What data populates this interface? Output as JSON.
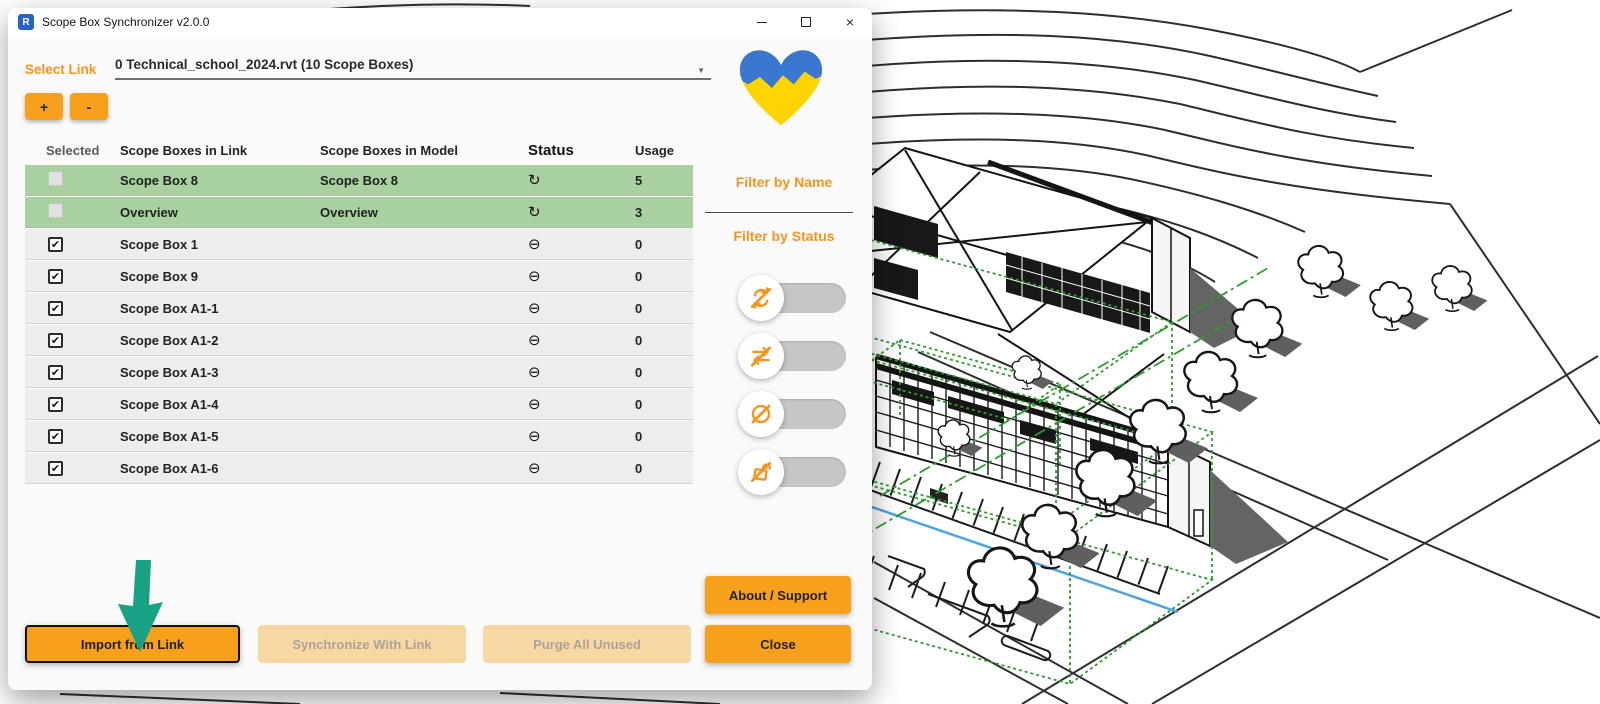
{
  "window": {
    "title": "Scope Box Synchronizer v2.0.0",
    "app_icon_letter": "R",
    "controls": {
      "minimize": "minimize",
      "maximize": "maximize",
      "close_glyph": "×"
    }
  },
  "link_selector": {
    "label": "Select Link",
    "value": "0 Technical_school_2024.rvt (10 Scope Boxes)",
    "dropdown_arrow": "▼",
    "add_label": "+",
    "remove_label": "-"
  },
  "table": {
    "columns": [
      "Selected",
      "Scope Boxes in Link",
      "Scope Boxes in Model",
      "Status",
      "Usage"
    ],
    "rows": [
      {
        "link": "Scope Box 8",
        "model": "Scope Box 8",
        "status": "synced",
        "status_glyph": "↻",
        "usage": "5",
        "checked": false,
        "checkbox_enabled": false,
        "highlighted": true
      },
      {
        "link": "Overview",
        "model": "Overview",
        "status": "synced",
        "status_glyph": "↻",
        "usage": "3",
        "checked": false,
        "checkbox_enabled": false,
        "highlighted": true
      },
      {
        "link": "Scope Box 1",
        "model": "",
        "status": "not-in-model",
        "status_glyph": "⊖",
        "usage": "0",
        "checked": true,
        "checkbox_enabled": true,
        "highlighted": false
      },
      {
        "link": "Scope Box 9",
        "model": "",
        "status": "not-in-model",
        "status_glyph": "⊖",
        "usage": "0",
        "checked": true,
        "checkbox_enabled": true,
        "highlighted": false
      },
      {
        "link": "Scope Box A1-1",
        "model": "",
        "status": "not-in-model",
        "status_glyph": "⊖",
        "usage": "0",
        "checked": true,
        "checkbox_enabled": true,
        "highlighted": false
      },
      {
        "link": "Scope Box A1-2",
        "model": "",
        "status": "not-in-model",
        "status_glyph": "⊖",
        "usage": "0",
        "checked": true,
        "checkbox_enabled": true,
        "highlighted": false
      },
      {
        "link": "Scope Box A1-3",
        "model": "",
        "status": "not-in-model",
        "status_glyph": "⊖",
        "usage": "0",
        "checked": true,
        "checkbox_enabled": true,
        "highlighted": false
      },
      {
        "link": "Scope Box A1-4",
        "model": "",
        "status": "not-in-model",
        "status_glyph": "⊖",
        "usage": "0",
        "checked": true,
        "checkbox_enabled": true,
        "highlighted": false
      },
      {
        "link": "Scope Box A1-5",
        "model": "",
        "status": "not-in-model",
        "status_glyph": "⊖",
        "usage": "0",
        "checked": true,
        "checkbox_enabled": true,
        "highlighted": false
      },
      {
        "link": "Scope Box A1-6",
        "model": "",
        "status": "not-in-model",
        "status_glyph": "⊖",
        "usage": "0",
        "checked": true,
        "checkbox_enabled": true,
        "highlighted": false
      }
    ]
  },
  "side_panel": {
    "filter_by_name_label": "Filter by Name",
    "filter_by_status_label": "Filter by Status",
    "toggles": [
      {
        "id": "filter-synced-toggle",
        "icon": "sync-off",
        "state": "off"
      },
      {
        "id": "filter-swapped-toggle",
        "icon": "swap-off",
        "state": "off"
      },
      {
        "id": "filter-not-visible-toggle",
        "icon": "visibility-off",
        "state": "off"
      },
      {
        "id": "filter-unused-toggle",
        "icon": "unused-off",
        "state": "off"
      }
    ]
  },
  "buttons": {
    "about": "About / Support",
    "import": "Import from Link",
    "synchronize": "Synchronize With Link",
    "purge": "Purge All Unused",
    "close": "Close"
  },
  "colors": {
    "accent_orange": "#F7941D",
    "button_orange": "#F7A01B",
    "disabled_button": "#F8D8A2",
    "row_green": "#A8D0A0",
    "row_gray": "#ECEDEF",
    "annotation_teal": "#17A286",
    "scope_box_green": "#2F9B2F",
    "utility_blue": "#4DA3E0"
  }
}
